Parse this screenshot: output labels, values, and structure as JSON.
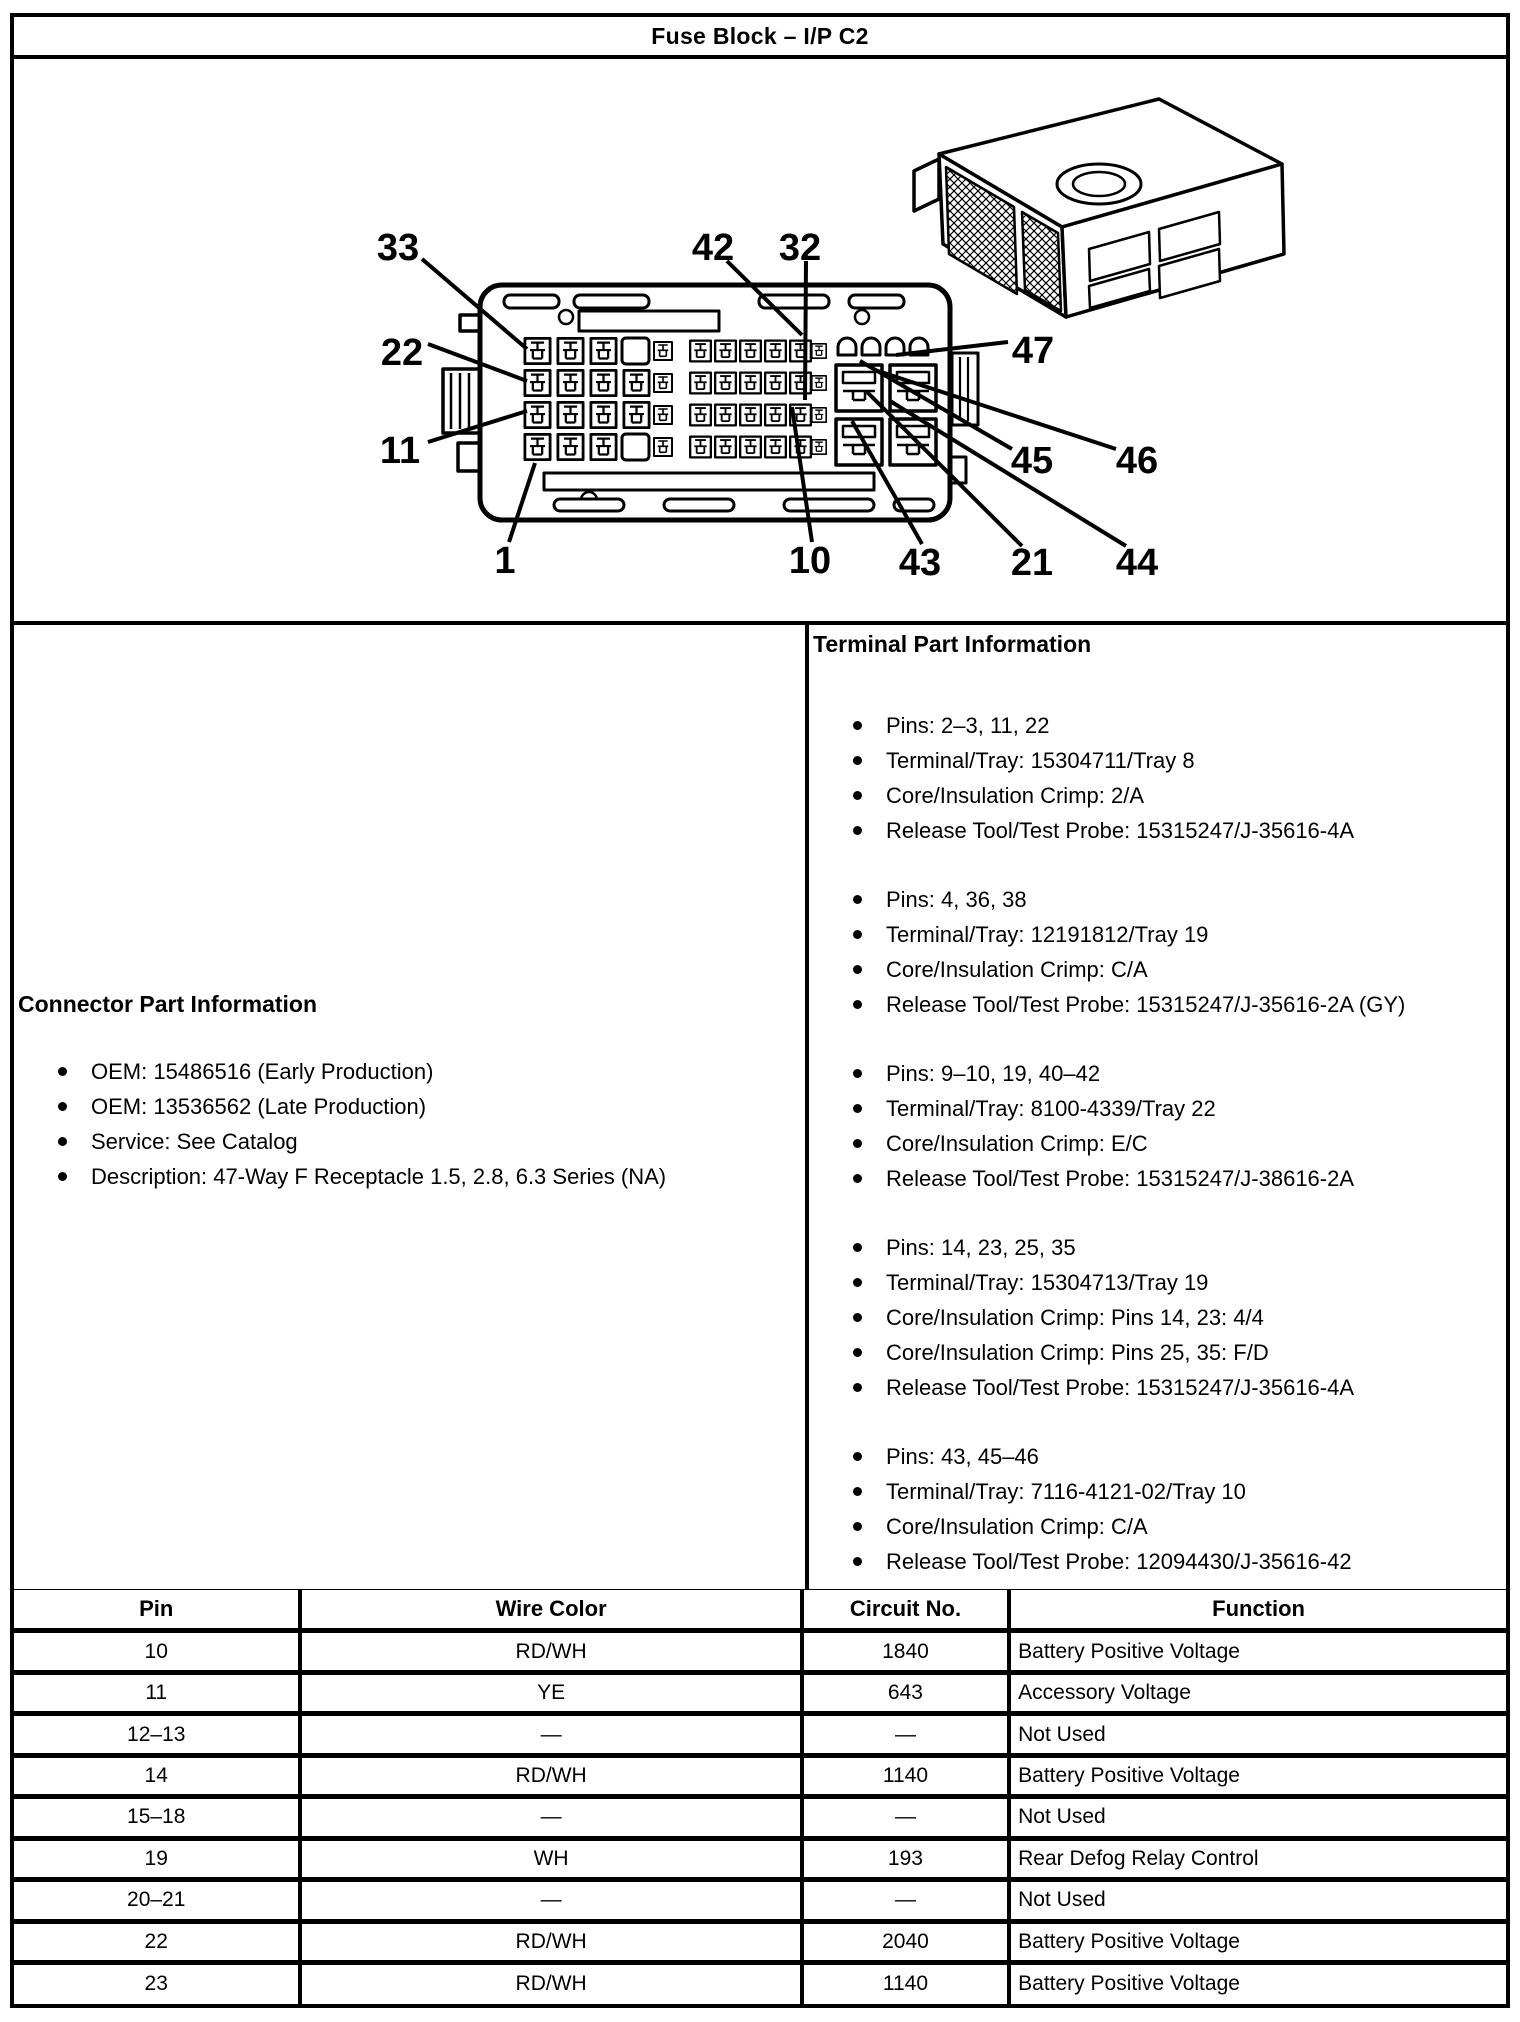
{
  "title": "Fuse Block – I/P C2",
  "diagram": {
    "callouts": [
      "33",
      "42",
      "32",
      "22",
      "11",
      "1",
      "10",
      "43",
      "21",
      "44",
      "45",
      "46",
      "47"
    ]
  },
  "connector_info": {
    "heading": "Connector Part Information",
    "items": [
      "OEM: 15486516 (Early Production)",
      "OEM: 13536562 (Late Production)",
      "Service: See Catalog",
      "Description: 47-Way F Receptacle 1.5, 2.8, 6.3 Series (NA)"
    ]
  },
  "terminal_info": {
    "heading": "Terminal Part Information",
    "groups": [
      {
        "items": [
          "Pins: 2–3, 11, 22",
          "Terminal/Tray: 15304711/Tray 8",
          "Core/Insulation Crimp: 2/A",
          "Release Tool/Test Probe: 15315247/J-35616-4A"
        ]
      },
      {
        "items": [
          "Pins: 4, 36, 38",
          "Terminal/Tray: 12191812/Tray 19",
          "Core/Insulation Crimp: C/A",
          "Release Tool/Test Probe: 15315247/J-35616-2A (GY)"
        ]
      },
      {
        "items": [
          "Pins: 9–10, 19, 40–42",
          "Terminal/Tray: 8100-4339/Tray 22",
          "Core/Insulation Crimp: E/C",
          "Release Tool/Test Probe: 15315247/J-38616-2A"
        ]
      },
      {
        "items": [
          "Pins: 14, 23, 25, 35",
          "Terminal/Tray: 15304713/Tray 19",
          "Core/Insulation Crimp: Pins 14, 23: 4/4",
          "Core/Insulation Crimp: Pins 25, 35: F/D",
          "Release Tool/Test Probe: 15315247/J-35616-4A"
        ]
      },
      {
        "items": [
          "Pins: 43, 45–46",
          "Terminal/Tray: 7116-4121-02/Tray 10",
          "Core/Insulation Crimp: C/A",
          "Release Tool/Test Probe: 12094430/J-35616-42"
        ]
      }
    ]
  },
  "pin_table": {
    "headers": [
      "Pin",
      "Wire Color",
      "Circuit No.",
      "Function"
    ],
    "rows": [
      [
        "10",
        "RD/WH",
        "1840",
        "Battery Positive Voltage"
      ],
      [
        "11",
        "YE",
        "643",
        "Accessory Voltage"
      ],
      [
        "12–13",
        "—",
        "—",
        "Not Used"
      ],
      [
        "14",
        "RD/WH",
        "1140",
        "Battery Positive Voltage"
      ],
      [
        "15–18",
        "—",
        "—",
        "Not Used"
      ],
      [
        "19",
        "WH",
        "193",
        "Rear Defog Relay Control"
      ],
      [
        "20–21",
        "—",
        "—",
        "Not Used"
      ],
      [
        "22",
        "RD/WH",
        "2040",
        "Battery Positive Voltage"
      ],
      [
        "23",
        "RD/WH",
        "1140",
        "Battery Positive Voltage"
      ]
    ]
  }
}
